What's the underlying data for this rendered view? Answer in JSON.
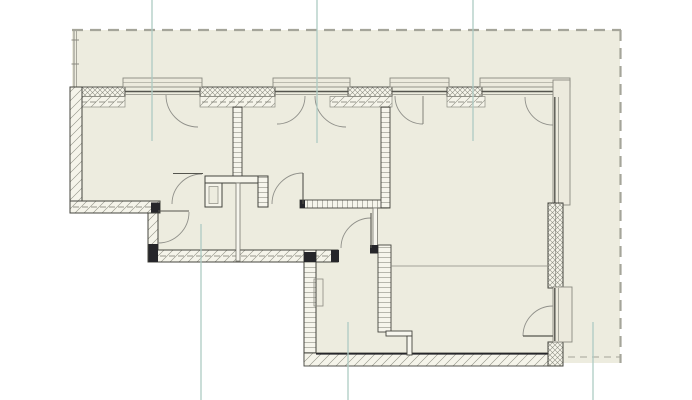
{
  "canvas": {
    "width": 692,
    "height": 400,
    "background": "#ffffff"
  },
  "palette": {
    "site_fill": "#edecdf",
    "wall_fill": "#f5f4ea",
    "window_fill": "#eceadd",
    "wall_outline": "#44443e",
    "hatch_line": "#8d8d82",
    "dark_cap": "#26262a",
    "boundary_dash": "#a5a59a",
    "grid_teal": "#aecbc4",
    "door_arc": "#90908a",
    "door_leaf": "#55554e"
  },
  "legend": {
    "drawing_type": "apartment floor plan",
    "hatches": [
      "cross = exterior masonry leaf",
      "diagonal = exterior wall / insulation",
      "rungs = interior partitions"
    ]
  },
  "elements": [
    {
      "name": "site-area",
      "type": "polygon",
      "points": "72,30 620,30 620,363 556,363 556,366 304,366 304,261 148,261 148,212 72,212",
      "fill": "#edecdf"
    },
    {
      "name": "fence-line-outer",
      "type": "line",
      "x1": 74,
      "y1": 30,
      "x2": 74,
      "y2": 88,
      "stroke": "#8a8a80",
      "sw": 1
    },
    {
      "name": "fence-line-inner",
      "type": "line",
      "x1": 76.5,
      "y1": 30,
      "x2": 76.5,
      "y2": 88,
      "stroke": "#8a8a80",
      "sw": 0.7
    },
    {
      "name": "fence-tick-1",
      "type": "line",
      "x1": 71.5,
      "y1": 40,
      "x2": 79,
      "y2": 40,
      "stroke": "#8a8a80",
      "sw": 1
    },
    {
      "name": "fence-tick-2",
      "type": "line",
      "x1": 71.5,
      "y1": 64,
      "x2": 79,
      "y2": 64,
      "stroke": "#8a8a80",
      "sw": 1
    },
    {
      "name": "boundary-top",
      "type": "line",
      "x1": 72,
      "y1": 30,
      "x2": 621,
      "y2": 30,
      "stroke": "#a5a59a",
      "sw": 2.2,
      "dash": "11 7"
    },
    {
      "name": "boundary-right",
      "type": "line",
      "x1": 620.5,
      "y1": 30,
      "x2": 620.5,
      "y2": 363,
      "stroke": "#a5a59a",
      "sw": 2.2,
      "dash": "11 7"
    },
    {
      "name": "boundary-bottom-right",
      "type": "line",
      "x1": 556,
      "y1": 357,
      "x2": 620,
      "y2": 357,
      "stroke": "#a5a59a",
      "sw": 1,
      "dash": "7 5"
    },
    {
      "name": "wall-top-pier-1",
      "type": "rect",
      "x": 70,
      "y": 87,
      "w": 55,
      "h": 9.5,
      "fill": "cross",
      "stroke": "#44443e",
      "sw": 0.9
    },
    {
      "name": "wall-top-pier-1-inner",
      "type": "rect",
      "x": 70,
      "y": 96.5,
      "w": 55,
      "h": 10.5,
      "fill": "diagw",
      "stroke": "#8a8a80",
      "sw": 0.7
    },
    {
      "name": "wall-top-pier-2",
      "type": "rect",
      "x": 200,
      "y": 87,
      "w": 75,
      "h": 9.5,
      "fill": "cross",
      "stroke": "#44443e",
      "sw": 0.9
    },
    {
      "name": "wall-top-pier-2-inner",
      "type": "rect",
      "x": 200,
      "y": 96.5,
      "w": 75,
      "h": 10.5,
      "fill": "diagw",
      "stroke": "#8a8a80",
      "sw": 0.7
    },
    {
      "name": "wall-top-pier-3",
      "type": "rect",
      "x": 348,
      "y": 87,
      "w": 44,
      "h": 9.5,
      "fill": "cross",
      "stroke": "#44443e",
      "sw": 0.9
    },
    {
      "name": "wall-top-pier-3-inner",
      "type": "rect",
      "x": 330,
      "y": 96.5,
      "w": 62,
      "h": 10.5,
      "fill": "diagw",
      "stroke": "#8a8a80",
      "sw": 0.7
    },
    {
      "name": "wall-top-pier-4",
      "type": "rect",
      "x": 447,
      "y": 87,
      "w": 35,
      "h": 9.5,
      "fill": "cross",
      "stroke": "#44443e",
      "sw": 0.9
    },
    {
      "name": "wall-top-pier-4-inner",
      "type": "rect",
      "x": 447,
      "y": 96.5,
      "w": 38,
      "h": 10.5,
      "fill": "diagw",
      "stroke": "#8a8a80",
      "sw": 0.7
    },
    {
      "name": "wall-top-insulation-dash-1",
      "type": "line",
      "x1": 72,
      "y1": 102,
      "x2": 124,
      "y2": 102,
      "stroke": "#77776e",
      "sw": 0.7,
      "dash": "6 3"
    },
    {
      "name": "wall-top-insulation-dash-2",
      "type": "line",
      "x1": 202,
      "y1": 102,
      "x2": 273,
      "y2": 102,
      "stroke": "#77776e",
      "sw": 0.7,
      "dash": "6 3"
    },
    {
      "name": "wall-top-insulation-dash-3",
      "type": "line",
      "x1": 332,
      "y1": 102,
      "x2": 390,
      "y2": 102,
      "stroke": "#77776e",
      "sw": 0.7,
      "dash": "6 3"
    },
    {
      "name": "wall-top-insulation-dash-4",
      "type": "line",
      "x1": 449,
      "y1": 102,
      "x2": 483,
      "y2": 102,
      "stroke": "#77776e",
      "sw": 0.7,
      "dash": "6 3"
    },
    {
      "name": "window-1-frame",
      "type": "rect",
      "x": 123,
      "y": 78,
      "w": 79,
      "h": 9,
      "fill": "#eceadd",
      "stroke": "#8a8a80",
      "sw": 0.9
    },
    {
      "name": "window-1-frame-midline",
      "type": "line",
      "x1": 123,
      "y1": 82.5,
      "x2": 202,
      "y2": 82.5,
      "stroke": "#8a8a80",
      "sw": 0.6
    },
    {
      "name": "window-1-glass-outer",
      "type": "line",
      "x1": 125,
      "y1": 91.5,
      "x2": 200,
      "y2": 91.5,
      "stroke": "#55554e",
      "sw": 1.4
    },
    {
      "name": "window-1-glass-inner",
      "type": "line",
      "x1": 125,
      "y1": 94.5,
      "x2": 200,
      "y2": 94.5,
      "stroke": "#8a8a80",
      "sw": 0.7
    },
    {
      "name": "window-1-casement-arc",
      "type": "path",
      "d": "M166,95 A32,32 0 0 0 198,127",
      "fill": "none",
      "stroke": "#90908a",
      "sw": 0.9
    },
    {
      "name": "window-2-frame",
      "type": "rect",
      "x": 273,
      "y": 78,
      "w": 77,
      "h": 9,
      "fill": "#eceadd",
      "stroke": "#8a8a80",
      "sw": 0.9
    },
    {
      "name": "window-2-frame-midline",
      "type": "line",
      "x1": 273,
      "y1": 82.5,
      "x2": 350,
      "y2": 82.5,
      "stroke": "#8a8a80",
      "sw": 0.6
    },
    {
      "name": "window-2-glass-outer",
      "type": "line",
      "x1": 275,
      "y1": 91.5,
      "x2": 348,
      "y2": 91.5,
      "stroke": "#55554e",
      "sw": 1.4
    },
    {
      "name": "window-2-glass-inner",
      "type": "line",
      "x1": 275,
      "y1": 94.5,
      "x2": 348,
      "y2": 94.5,
      "stroke": "#8a8a80",
      "sw": 0.7
    },
    {
      "name": "window-2-casement-arc-left",
      "type": "path",
      "d": "M305,96 A28,28 0 0 1 277,124",
      "fill": "none",
      "stroke": "#90908a",
      "sw": 0.9
    },
    {
      "name": "window-2-casement-arc-right",
      "type": "path",
      "d": "M315,96 A31,31 0 0 0 346,127",
      "fill": "none",
      "stroke": "#90908a",
      "sw": 0.9
    },
    {
      "name": "window-3-frame",
      "type": "rect",
      "x": 390,
      "y": 78,
      "w": 59,
      "h": 9,
      "fill": "#eceadd",
      "stroke": "#8a8a80",
      "sw": 0.9
    },
    {
      "name": "window-3-frame-midline",
      "type": "line",
      "x1": 390,
      "y1": 82.5,
      "x2": 449,
      "y2": 82.5,
      "stroke": "#8a8a80",
      "sw": 0.6
    },
    {
      "name": "window-3-glass-outer",
      "type": "line",
      "x1": 392,
      "y1": 91.5,
      "x2": 447,
      "y2": 91.5,
      "stroke": "#55554e",
      "sw": 1.4
    },
    {
      "name": "window-3-glass-inner",
      "type": "line",
      "x1": 392,
      "y1": 94.5,
      "x2": 447,
      "y2": 94.5,
      "stroke": "#8a8a80",
      "sw": 0.7
    },
    {
      "name": "window-3-casement-arc",
      "type": "path",
      "d": "M395,96 A28,28 0 0 0 423,124",
      "fill": "none",
      "stroke": "#90908a",
      "sw": 0.9
    },
    {
      "name": "window-3-casement-leaf",
      "type": "line",
      "x1": 423,
      "y1": 96,
      "x2": 423,
      "y2": 124,
      "stroke": "#77776e",
      "sw": 0.9
    },
    {
      "name": "window-4-corner-top-frame",
      "type": "rect",
      "x": 480,
      "y": 78,
      "w": 90,
      "h": 9,
      "fill": "#eceadd",
      "stroke": "#8a8a80",
      "sw": 0.9
    },
    {
      "name": "window-4-corner-top-midline",
      "type": "line",
      "x1": 480,
      "y1": 82.5,
      "x2": 568,
      "y2": 82.5,
      "stroke": "#8a8a80",
      "sw": 0.6
    },
    {
      "name": "window-4-glass-outer",
      "type": "line",
      "x1": 482,
      "y1": 91.5,
      "x2": 554,
      "y2": 91.5,
      "stroke": "#55554e",
      "sw": 1.4
    },
    {
      "name": "window-4-glass-inner",
      "type": "line",
      "x1": 482,
      "y1": 94.5,
      "x2": 554,
      "y2": 94.5,
      "stroke": "#8a8a80",
      "sw": 0.7
    },
    {
      "name": "window-4-casement-arc",
      "type": "path",
      "d": "M525,97 A28,28 0 0 0 553,125",
      "fill": "none",
      "stroke": "#90908a",
      "sw": 0.9
    },
    {
      "name": "window-4-corner-right-frame",
      "type": "rect",
      "x": 553,
      "y": 80,
      "w": 17,
      "h": 125,
      "fill": "#eceadd",
      "stroke": "#8a8a80",
      "sw": 0.9
    },
    {
      "name": "window-4-right-glass-outer",
      "type": "line",
      "x1": 554.8,
      "y1": 97,
      "x2": 554.8,
      "y2": 205,
      "stroke": "#55554e",
      "sw": 1.4
    },
    {
      "name": "window-4-right-glass-inner",
      "type": "line",
      "x1": 558.5,
      "y1": 97,
      "x2": 558.5,
      "y2": 205,
      "stroke": "#8a8a80",
      "sw": 0.7
    },
    {
      "name": "wall-left-exterior",
      "type": "rect",
      "x": 70,
      "y": 87,
      "w": 12,
      "h": 126,
      "fill": "diagw",
      "stroke": "#44443e",
      "sw": 1
    },
    {
      "name": "wall-step-south",
      "type": "rect",
      "x": 70,
      "y": 201,
      "w": 90,
      "h": 12,
      "fill": "diagw",
      "stroke": "#44443e",
      "sw": 1
    },
    {
      "name": "wall-step-south-dashline",
      "type": "line",
      "x1": 73,
      "y1": 207,
      "x2": 157,
      "y2": 207,
      "stroke": "#77776e",
      "sw": 0.7,
      "dash": "6 3"
    },
    {
      "name": "wall-step-vertical",
      "type": "rect",
      "x": 148,
      "y": 213,
      "w": 10,
      "h": 38,
      "fill": "diagw",
      "stroke": "#44443e",
      "sw": 1
    },
    {
      "name": "wall-corridor-south",
      "type": "rect",
      "x": 148,
      "y": 250,
      "w": 190,
      "h": 12,
      "fill": "diagw",
      "stroke": "#44443e",
      "sw": 1
    },
    {
      "name": "wall-corridor-south-dashline",
      "type": "line",
      "x1": 151,
      "y1": 256,
      "x2": 330,
      "y2": 256,
      "stroke": "#77776e",
      "sw": 0.7,
      "dash": "6 3"
    },
    {
      "name": "wall-bottomleft-west",
      "type": "rect",
      "x": 304,
      "y": 250,
      "w": 12,
      "h": 112,
      "fill": "ladderH",
      "stroke": "#44443e",
      "sw": 1
    },
    {
      "name": "wall-bottom-south",
      "type": "rect",
      "x": 304,
      "y": 353,
      "w": 259,
      "h": 13,
      "fill": "diagw",
      "stroke": "#44443e",
      "sw": 0.9
    },
    {
      "name": "wall-bottom-south-edge",
      "type": "line",
      "x1": 316,
      "y1": 353.8,
      "x2": 556,
      "y2": 353.8,
      "stroke": "#26262a",
      "sw": 1.6
    },
    {
      "name": "wall-right-upper",
      "type": "rect",
      "x": 548,
      "y": 203,
      "w": 15,
      "h": 85,
      "fill": "cross",
      "stroke": "#44443e",
      "sw": 1
    },
    {
      "name": "wall-right-upper-divider",
      "type": "line",
      "x1": 555.5,
      "y1": 203,
      "x2": 555.5,
      "y2": 288,
      "stroke": "#77776e",
      "sw": 0.6
    },
    {
      "name": "wall-right-lower",
      "type": "rect",
      "x": 548,
      "y": 342,
      "w": 15,
      "h": 24,
      "fill": "cross",
      "stroke": "#44443e",
      "sw": 1
    },
    {
      "name": "balcony-door-frame",
      "type": "rect",
      "x": 553,
      "y": 287,
      "w": 19,
      "h": 55,
      "fill": "#eceadd",
      "stroke": "#8a8a80",
      "sw": 0.9
    },
    {
      "name": "balcony-door-glass-outer",
      "type": "line",
      "x1": 554.8,
      "y1": 288,
      "x2": 554.8,
      "y2": 341,
      "stroke": "#55554e",
      "sw": 1.4
    },
    {
      "name": "balcony-door-glass-inner",
      "type": "line",
      "x1": 558.5,
      "y1": 288,
      "x2": 558.5,
      "y2": 341,
      "stroke": "#8a8a80",
      "sw": 0.7
    },
    {
      "name": "balcony-door-arc",
      "type": "path",
      "d": "M523,336 A30,30 0 0 1 553,306",
      "fill": "none",
      "stroke": "#90908a",
      "sw": 0.9
    },
    {
      "name": "balcony-door-leaf",
      "type": "line",
      "x1": 523,
      "y1": 336,
      "x2": 553,
      "y2": 336,
      "stroke": "#55554e",
      "sw": 1.2
    },
    {
      "name": "partition-room1-room2",
      "type": "rect",
      "x": 233,
      "y": 107,
      "w": 9,
      "h": 69,
      "fill": "ladderH",
      "stroke": "#44443e",
      "sw": 0.9
    },
    {
      "name": "shaft-header",
      "type": "rect",
      "x": 205,
      "y": 176,
      "w": 63,
      "h": 7,
      "fill": "#f5f4ea",
      "stroke": "#44443e",
      "sw": 1
    },
    {
      "name": "shaft-left-block",
      "type": "rect",
      "x": 205,
      "y": 183,
      "w": 17,
      "h": 24,
      "fill": "#f5f4ea",
      "stroke": "#44443e",
      "sw": 1
    },
    {
      "name": "shaft-left-inner",
      "type": "rect",
      "x": 209,
      "y": 186.5,
      "w": 9,
      "h": 17,
      "fill": "#edecdf",
      "stroke": "#8a8a80",
      "sw": 0.7
    },
    {
      "name": "shaft-right-block",
      "type": "rect",
      "x": 258,
      "y": 176,
      "w": 10,
      "h": 31,
      "fill": "ladderH",
      "stroke": "#44443e",
      "sw": 1
    },
    {
      "name": "partition-thin-corridor",
      "type": "rect",
      "x": 236,
      "y": 183,
      "w": 4,
      "h": 78,
      "fill": "#f7f6ee",
      "stroke": "#77776e",
      "sw": 0.8
    },
    {
      "name": "partition-room2-south",
      "type": "rect",
      "x": 300,
      "y": 200,
      "w": 87,
      "h": 8,
      "fill": "ladderV",
      "stroke": "#44443e",
      "sw": 0.9
    },
    {
      "name": "partition-room2-south-cap",
      "type": "rect",
      "x": 300,
      "y": 200,
      "w": 5,
      "h": 8,
      "fill": "#26262a"
    },
    {
      "name": "partition-room2-room3",
      "type": "rect",
      "x": 381,
      "y": 107,
      "w": 9,
      "h": 101,
      "fill": "ladderH",
      "stroke": "#44443e",
      "sw": 0.9
    },
    {
      "name": "partition-thin-east",
      "type": "rect",
      "x": 373,
      "y": 208,
      "w": 4.5,
      "h": 42,
      "fill": "#f7f6ee",
      "stroke": "#77776e",
      "sw": 0.8
    },
    {
      "name": "partition-lower-rooms",
      "type": "rect",
      "x": 378,
      "y": 245,
      "w": 13,
      "h": 87,
      "fill": "ladderH",
      "stroke": "#44443e",
      "sw": 0.9
    },
    {
      "name": "doorway-header",
      "type": "rect",
      "x": 386,
      "y": 331,
      "w": 26,
      "h": 5,
      "fill": "#f7f6ee",
      "stroke": "#44443e",
      "sw": 0.9
    },
    {
      "name": "doorway-jamb",
      "type": "rect",
      "x": 407,
      "y": 336,
      "w": 5,
      "h": 19,
      "fill": "#f7f6ee",
      "stroke": "#44443e",
      "sw": 0.9
    },
    {
      "name": "radiator-panel",
      "type": "rect",
      "x": 314,
      "y": 279,
      "w": 9,
      "h": 27,
      "fill": "none",
      "stroke": "#8a8a80",
      "sw": 0.8
    },
    {
      "name": "opening-line-living",
      "type": "line",
      "x1": 391,
      "y1": 266,
      "x2": 547,
      "y2": 266,
      "stroke": "#8a8a80",
      "sw": 0.8
    },
    {
      "name": "cap-step-corner",
      "type": "rect",
      "x": 151,
      "y": 202.5,
      "w": 9,
      "h": 10,
      "fill": "#26262a"
    },
    {
      "name": "cap-step-bottom",
      "type": "rect",
      "x": 148.5,
      "y": 244,
      "w": 9.5,
      "h": 18,
      "fill": "#26262a"
    },
    {
      "name": "cap-corridor-east",
      "type": "rect",
      "x": 331,
      "y": 250,
      "w": 8,
      "h": 12,
      "fill": "#26262a"
    },
    {
      "name": "cap-bottomleft-corner",
      "type": "rect",
      "x": 304,
      "y": 252,
      "w": 12,
      "h": 10,
      "fill": "#26262a"
    },
    {
      "name": "cap-door4-hinge",
      "type": "rect",
      "x": 370,
      "y": 245,
      "w": 8,
      "h": 8.5,
      "fill": "#26262a"
    },
    {
      "name": "door-room1-arc",
      "type": "path",
      "d": "M172,204 A30,30 0 0 1 202,174",
      "fill": "none",
      "stroke": "#90908a",
      "sw": 0.9
    },
    {
      "name": "door-room1-leaf",
      "type": "line",
      "x1": 173,
      "y1": 173.5,
      "x2": 203,
      "y2": 173.5,
      "stroke": "#55554e",
      "sw": 1.1
    },
    {
      "name": "door-corridor-arc",
      "type": "path",
      "d": "M189,212 A31,31 0 0 1 158,243",
      "fill": "none",
      "stroke": "#90908a",
      "sw": 0.9
    },
    {
      "name": "door-corridor-leaf",
      "type": "line",
      "x1": 158,
      "y1": 211,
      "x2": 189,
      "y2": 211,
      "stroke": "#55554e",
      "sw": 1.1
    },
    {
      "name": "door-room2-arc",
      "type": "path",
      "d": "M272,204 A31,31 0 0 1 303,173",
      "fill": "none",
      "stroke": "#90908a",
      "sw": 0.9
    },
    {
      "name": "door-room2-leaf",
      "type": "line",
      "x1": 303,
      "y1": 173,
      "x2": 303,
      "y2": 204,
      "stroke": "#55554e",
      "sw": 1.1
    },
    {
      "name": "door-living-arc",
      "type": "path",
      "d": "M341,248 A30,30 0 0 1 371,218",
      "fill": "none",
      "stroke": "#90908a",
      "sw": 0.9
    },
    {
      "name": "door-living-leaf",
      "type": "line",
      "x1": 371,
      "y1": 213,
      "x2": 371,
      "y2": 248,
      "stroke": "#55554e",
      "sw": 1.1
    },
    {
      "name": "grid-line-top-1",
      "type": "line",
      "x1": 152,
      "y1": 0,
      "x2": 152,
      "y2": 141,
      "stroke": "#aecbc4",
      "sw": 1.3
    },
    {
      "name": "grid-line-top-2",
      "type": "line",
      "x1": 317,
      "y1": 0,
      "x2": 317,
      "y2": 143,
      "stroke": "#aecbc4",
      "sw": 1.3
    },
    {
      "name": "grid-line-top-3",
      "type": "line",
      "x1": 473,
      "y1": 0,
      "x2": 473,
      "y2": 141,
      "stroke": "#aecbc4",
      "sw": 1.3
    },
    {
      "name": "grid-line-bottom-1",
      "type": "line",
      "x1": 201,
      "y1": 224,
      "x2": 201,
      "y2": 400,
      "stroke": "#aecbc4",
      "sw": 1.3
    },
    {
      "name": "grid-line-bottom-2",
      "type": "line",
      "x1": 348,
      "y1": 322,
      "x2": 348,
      "y2": 400,
      "stroke": "#aecbc4",
      "sw": 1.3
    },
    {
      "name": "grid-line-bottom-3",
      "type": "line",
      "x1": 593,
      "y1": 322,
      "x2": 593,
      "y2": 400,
      "stroke": "#aecbc4",
      "sw": 1.3
    }
  ]
}
